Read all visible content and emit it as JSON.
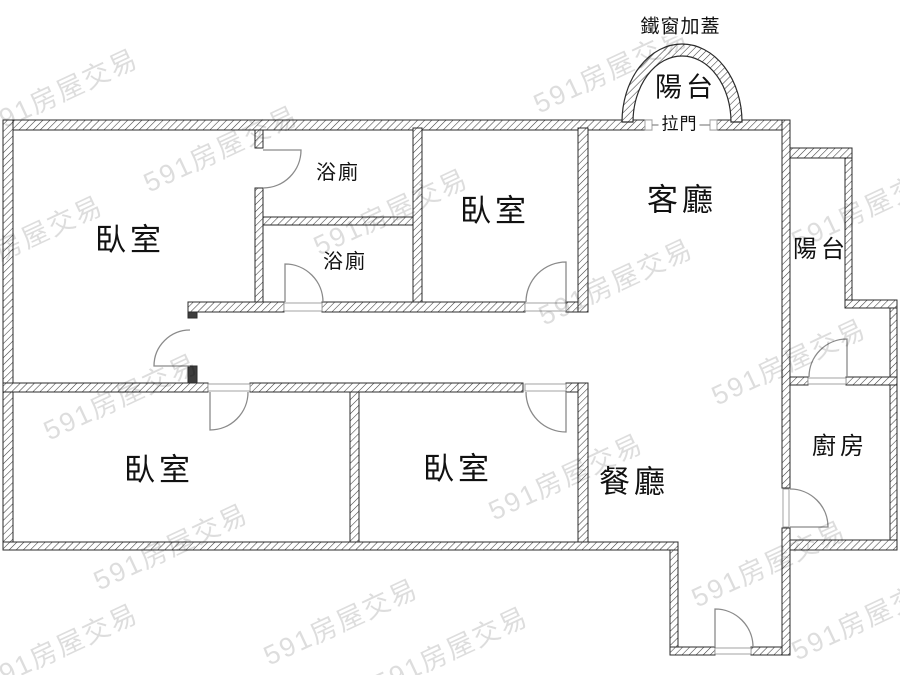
{
  "plan": {
    "rooms": {
      "bedroom_top_left": "臥室",
      "bathroom_upper": "浴廁",
      "bathroom_lower": "浴廁",
      "bedroom_top_middle": "臥室",
      "living_room": "客廳",
      "balcony_top": "陽台",
      "balcony_right": "陽台",
      "kitchen": "廚房",
      "dining_room": "餐廳",
      "bedroom_bottom_left": "臥室",
      "bedroom_bottom_middle": "臥室"
    },
    "annotations": {
      "iron_window_cover": "鐵窗加蓋",
      "sliding_door": "拉門"
    },
    "colors": {
      "background": "#ffffff",
      "wall_outline": "#2b2b2b",
      "wall_hatch": "#3d3d3d",
      "door_line": "#8a8a8a",
      "label_text": "#111111",
      "watermark_gray": "#dedede"
    }
  },
  "watermark": {
    "text": "591房屋交易"
  }
}
